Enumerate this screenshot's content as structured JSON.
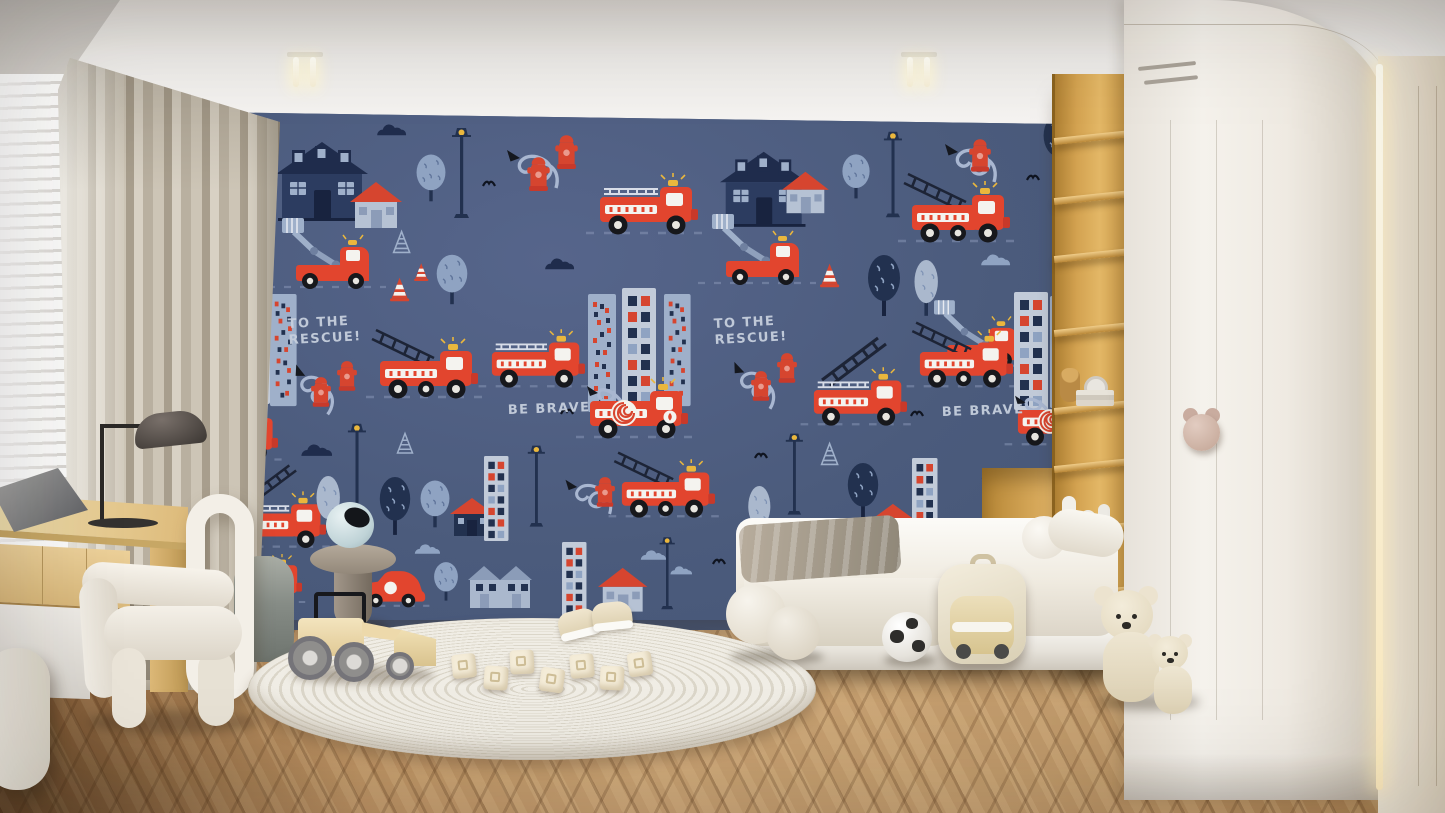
{
  "scene_label": "children's bedroom interior with navy fire-truck wall mural",
  "colors": {
    "mural_navy": "#4b5b7c",
    "truck_red": "#e2452e",
    "accent_navy": "#1f2c4c",
    "accent_pale_blue": "#9fb0ca",
    "accent_yellow": "#eab73d",
    "mural_text": "#c6cfdd",
    "curtain_beige": "#c2b9a9",
    "curtain_gold": "#cda94e",
    "desk_wood": "#ddba7a",
    "shelf_wood": "#d3a250",
    "wardrobe_white": "#f5f2ec",
    "handle_pink": "#c9ac9f",
    "floor_wood": "#c9a273",
    "rug_ivory": "#f0ede5",
    "bedding_white": "#fcfbf8"
  },
  "wall_mural": {
    "background": "#4b5b7c",
    "texts": {
      "rescue_line1": "TO THE",
      "rescue_line2": "RESCUE!",
      "brave": "BE BRAVE"
    },
    "motif_types": [
      "truck-engine",
      "truck-ladder",
      "truck-hose",
      "truck-bucket",
      "car-red",
      "house-navy",
      "house-small",
      "house-navysm",
      "rowhouse",
      "building-dots",
      "building-grid",
      "tree-round",
      "tree-dark",
      "tree-pale",
      "lamp",
      "hydrant",
      "hose-curl",
      "ladder",
      "cone",
      "cone-outline",
      "cloud-navy",
      "cloud-pale",
      "bird"
    ],
    "motifs": [
      {
        "t": "tree-dark",
        "x": -6,
        "y": -4,
        "s": 0.9
      },
      {
        "t": "bird",
        "x": 56,
        "y": 14,
        "s": 1
      },
      {
        "t": "house-navy",
        "x": 80,
        "y": 26,
        "s": 1
      },
      {
        "t": "house-small",
        "x": 154,
        "y": 68,
        "s": 1
      },
      {
        "t": "cloud-navy",
        "x": 178,
        "y": 12,
        "s": 0.8
      },
      {
        "t": "tree-round",
        "x": 218,
        "y": 40,
        "s": 0.85
      },
      {
        "t": "lamp",
        "x": 254,
        "y": 12,
        "s": 1
      },
      {
        "t": "hose-curl",
        "x": 296,
        "y": 16,
        "s": 1
      },
      {
        "t": "hydrant",
        "x": 330,
        "y": 44,
        "s": 1.25
      },
      {
        "t": "hydrant",
        "x": 358,
        "y": 22,
        "s": 1.25
      },
      {
        "t": "bird",
        "x": 286,
        "y": 66,
        "s": 1
      },
      {
        "t": "truck-engine",
        "x": 402,
        "y": 66,
        "s": 1
      },
      {
        "t": "house-navy",
        "x": 524,
        "y": 36,
        "s": 0.95
      },
      {
        "t": "house-small",
        "x": 586,
        "y": 58,
        "s": 0.9
      },
      {
        "t": "tree-round",
        "x": 644,
        "y": 40,
        "s": 0.8
      },
      {
        "t": "lamp",
        "x": 686,
        "y": 16,
        "s": 0.95
      },
      {
        "t": "hose-curl",
        "x": 734,
        "y": 10,
        "s": 1
      },
      {
        "t": "hydrant",
        "x": 772,
        "y": 26,
        "s": 1.2
      },
      {
        "t": "truck-ladder",
        "x": 714,
        "y": 74,
        "s": 1
      },
      {
        "t": "tree-dark",
        "x": 844,
        "y": 2,
        "s": 0.9
      },
      {
        "t": "bird",
        "x": 830,
        "y": 60,
        "s": 1
      },
      {
        "t": "hose-curl",
        "x": 862,
        "y": 10,
        "s": 0.9
      },
      {
        "t": "hydrant",
        "x": 884,
        "y": 34,
        "s": 1.3
      },
      {
        "t": "hydrant",
        "x": 910,
        "y": 52,
        "s": 1.3
      },
      {
        "t": "truck-engine",
        "x": -42,
        "y": 70,
        "s": 1
      },
      {
        "t": "truck-bucket",
        "x": 86,
        "y": 112,
        "s": 1
      },
      {
        "t": "cone-outline",
        "x": 196,
        "y": 118,
        "s": 0.8
      },
      {
        "t": "cone",
        "x": 194,
        "y": 164,
        "s": 0.8
      },
      {
        "t": "cone",
        "x": 218,
        "y": 150,
        "s": 0.6
      },
      {
        "t": "tree-round",
        "x": 238,
        "y": 140,
        "s": 0.9
      },
      {
        "t": "cloud-navy",
        "x": 26,
        "y": 132,
        "s": 0.9
      },
      {
        "t": "cloud-navy",
        "x": 346,
        "y": 146,
        "s": 0.8
      },
      {
        "t": "truck-bucket",
        "x": 516,
        "y": 108,
        "s": 1
      },
      {
        "t": "cone",
        "x": 624,
        "y": 150,
        "s": 0.8
      },
      {
        "t": "tree-dark",
        "x": 668,
        "y": 142,
        "s": 1
      },
      {
        "t": "tree-pale",
        "x": 714,
        "y": 148,
        "s": 0.9
      },
      {
        "t": "cloud-pale",
        "x": 782,
        "y": 142,
        "s": 0.8
      },
      {
        "t": "cloud-navy",
        "x": 892,
        "y": 148,
        "s": 0.9
      },
      {
        "t": "truck-bucket",
        "x": 738,
        "y": 194,
        "s": 0.95
      },
      {
        "t": "building-dots",
        "x": 10,
        "y": 182,
        "s": 1
      },
      {
        "t": "building-grid",
        "x": 40,
        "y": 174,
        "s": 1
      },
      {
        "t": "building-dots",
        "x": 74,
        "y": 182,
        "s": 0.95
      },
      {
        "t": "hose-curl",
        "x": 94,
        "y": 228,
        "s": 0.95,
        "r": 20
      },
      {
        "t": "hydrant",
        "x": 114,
        "y": 264,
        "s": 1.1
      },
      {
        "t": "hydrant",
        "x": 140,
        "y": 248,
        "s": 1.1
      },
      {
        "t": "truck-ladder",
        "x": 182,
        "y": 230,
        "s": 1
      },
      {
        "t": "truck-engine",
        "x": 294,
        "y": 222,
        "s": 0.95
      },
      {
        "t": "building-dots",
        "x": 392,
        "y": 182,
        "s": 1
      },
      {
        "t": "building-grid",
        "x": 426,
        "y": 176,
        "s": 1
      },
      {
        "t": "building-dots",
        "x": 468,
        "y": 182,
        "s": 0.95
      },
      {
        "t": "hose-curl",
        "x": 530,
        "y": 226,
        "s": 0.95,
        "r": 15
      },
      {
        "t": "hydrant",
        "x": 554,
        "y": 258,
        "s": 1.1
      },
      {
        "t": "hydrant",
        "x": 580,
        "y": 240,
        "s": 1.1
      },
      {
        "t": "ladder",
        "x": 624,
        "y": 222,
        "s": 1
      },
      {
        "t": "truck-engine",
        "x": 616,
        "y": 260,
        "s": 0.95
      },
      {
        "t": "truck-ladder",
        "x": 722,
        "y": 222,
        "s": 0.95
      },
      {
        "t": "building-grid",
        "x": 818,
        "y": 180,
        "s": 1
      },
      {
        "t": "building-dots",
        "x": 854,
        "y": 184,
        "s": 0.95
      },
      {
        "t": "building-grid",
        "x": 886,
        "y": 182,
        "s": 1
      },
      {
        "t": "truck-hose",
        "x": 392,
        "y": 270,
        "s": 1
      },
      {
        "t": "truck-hose",
        "x": 820,
        "y": 280,
        "s": 0.95
      },
      {
        "t": "bird",
        "x": 364,
        "y": 294,
        "s": 1
      },
      {
        "t": "bird",
        "x": 714,
        "y": 296,
        "s": 1
      },
      {
        "t": "truck-engine",
        "x": -8,
        "y": 298,
        "s": 0.9
      },
      {
        "t": "ladder",
        "x": 44,
        "y": 350,
        "s": 0.85
      },
      {
        "t": "truck-engine",
        "x": 38,
        "y": 384,
        "s": 0.92
      },
      {
        "t": "cloud-navy",
        "x": 102,
        "y": 332,
        "s": 0.85
      },
      {
        "t": "tree-pale",
        "x": 116,
        "y": 364,
        "s": 0.9
      },
      {
        "t": "lamp",
        "x": 150,
        "y": 308,
        "s": 0.95
      },
      {
        "t": "tree-dark",
        "x": 180,
        "y": 364,
        "s": 0.95
      },
      {
        "t": "cone-outline",
        "x": 200,
        "y": 320,
        "s": 0.75
      },
      {
        "t": "tree-round",
        "x": 222,
        "y": 366,
        "s": 0.85
      },
      {
        "t": "house-navysm",
        "x": 254,
        "y": 384,
        "s": 1
      },
      {
        "t": "building-grid",
        "x": 288,
        "y": 344,
        "s": 0.72
      },
      {
        "t": "lamp",
        "x": 330,
        "y": 330,
        "s": 0.9
      },
      {
        "t": "hose-curl",
        "x": 356,
        "y": 348,
        "s": 0.9
      },
      {
        "t": "hydrant",
        "x": 398,
        "y": 364,
        "s": 1.1
      },
      {
        "t": "truck-ladder",
        "x": 424,
        "y": 352,
        "s": 0.95
      },
      {
        "t": "tree-pale",
        "x": 548,
        "y": 374,
        "s": 0.85
      },
      {
        "t": "lamp",
        "x": 588,
        "y": 318,
        "s": 0.9
      },
      {
        "t": "cone-outline",
        "x": 624,
        "y": 330,
        "s": 0.8
      },
      {
        "t": "tree-dark",
        "x": 648,
        "y": 350,
        "s": 0.95
      },
      {
        "t": "house-navysm",
        "x": 676,
        "y": 390,
        "s": 0.95
      },
      {
        "t": "building-grid",
        "x": 716,
        "y": 346,
        "s": 0.75
      },
      {
        "t": "hose-curl",
        "x": 776,
        "y": 344,
        "s": 0.9,
        "r": 10
      },
      {
        "t": "hydrant",
        "x": 806,
        "y": 368,
        "s": 1.1
      },
      {
        "t": "bird",
        "x": 558,
        "y": 338,
        "s": 1
      },
      {
        "t": "truck-engine",
        "x": 26,
        "y": 446,
        "s": 0.8
      },
      {
        "t": "car-red",
        "x": 162,
        "y": 456,
        "s": 1.05
      },
      {
        "t": "cloud-pale",
        "x": 216,
        "y": 432,
        "s": 0.7
      },
      {
        "t": "tree-round",
        "x": 236,
        "y": 448,
        "s": 0.7
      },
      {
        "t": "rowhouse",
        "x": 272,
        "y": 448,
        "s": 1
      },
      {
        "t": "building-grid",
        "x": 366,
        "y": 430,
        "s": 0.72
      },
      {
        "t": "house-small",
        "x": 402,
        "y": 454,
        "s": 0.95
      },
      {
        "t": "cloud-pale",
        "x": 442,
        "y": 438,
        "s": 0.7
      },
      {
        "t": "cloud-pale",
        "x": 472,
        "y": 454,
        "s": 0.6
      },
      {
        "t": "lamp",
        "x": 462,
        "y": 422,
        "s": 0.8
      },
      {
        "t": "bird",
        "x": 516,
        "y": 444,
        "s": 1
      },
      {
        "t": "hydrant",
        "x": 816,
        "y": 384,
        "s": 1.2
      },
      {
        "t": "car-red",
        "x": 848,
        "y": 392,
        "s": 0.9
      }
    ]
  },
  "room_objects": [
    {
      "name": "window-blinds",
      "desc": "white venetian blinds, bright daylight"
    },
    {
      "name": "curtains",
      "desc": "beige/greige pleated curtains with gold sheer layer"
    },
    {
      "name": "desk",
      "desc": "light oak desk with drawers and white cabinet"
    },
    {
      "name": "desk-lamp",
      "desc": "black dome task lamp"
    },
    {
      "name": "laptop",
      "desc": "gray laptop on desk"
    },
    {
      "name": "chair",
      "desc": "white sculptural tubular armchair"
    },
    {
      "name": "pouf",
      "desc": "gray-green velvet pouf"
    },
    {
      "name": "side-table",
      "desc": "taupe mushroom side table with blue sphere vase"
    },
    {
      "name": "rug",
      "desc": "round ivory braided rug"
    },
    {
      "name": "toy-loader",
      "desc": "wooden toy front loader"
    },
    {
      "name": "toy-blocks",
      "desc": "cream letter blocks"
    },
    {
      "name": "baby-sneakers",
      "desc": "pair of cream baby sneakers"
    },
    {
      "name": "bed",
      "desc": "low white bed with duvet, gray blanket, bolster pillows"
    },
    {
      "name": "ball-cushions",
      "desc": "two cream sphere cushions on floor"
    },
    {
      "name": "soccer-ball",
      "desc": "white soccer ball"
    },
    {
      "name": "backpack",
      "desc": "cream kids backpack with car design"
    },
    {
      "name": "teddy-bears",
      "desc": "two cream teddy bears"
    },
    {
      "name": "shelf-unit",
      "desc": "tall oak open shelving with toys, clock, books"
    },
    {
      "name": "wardrobe",
      "desc": "white wardrobe with rounded corner and pink bear handle"
    },
    {
      "name": "accent-wall",
      "desc": "beige paneled wall with LED strip"
    },
    {
      "name": "floor",
      "desc": "herringbone wood floor"
    },
    {
      "name": "ceiling-lights",
      "desc": "two twin-tube ceiling lights"
    }
  ]
}
